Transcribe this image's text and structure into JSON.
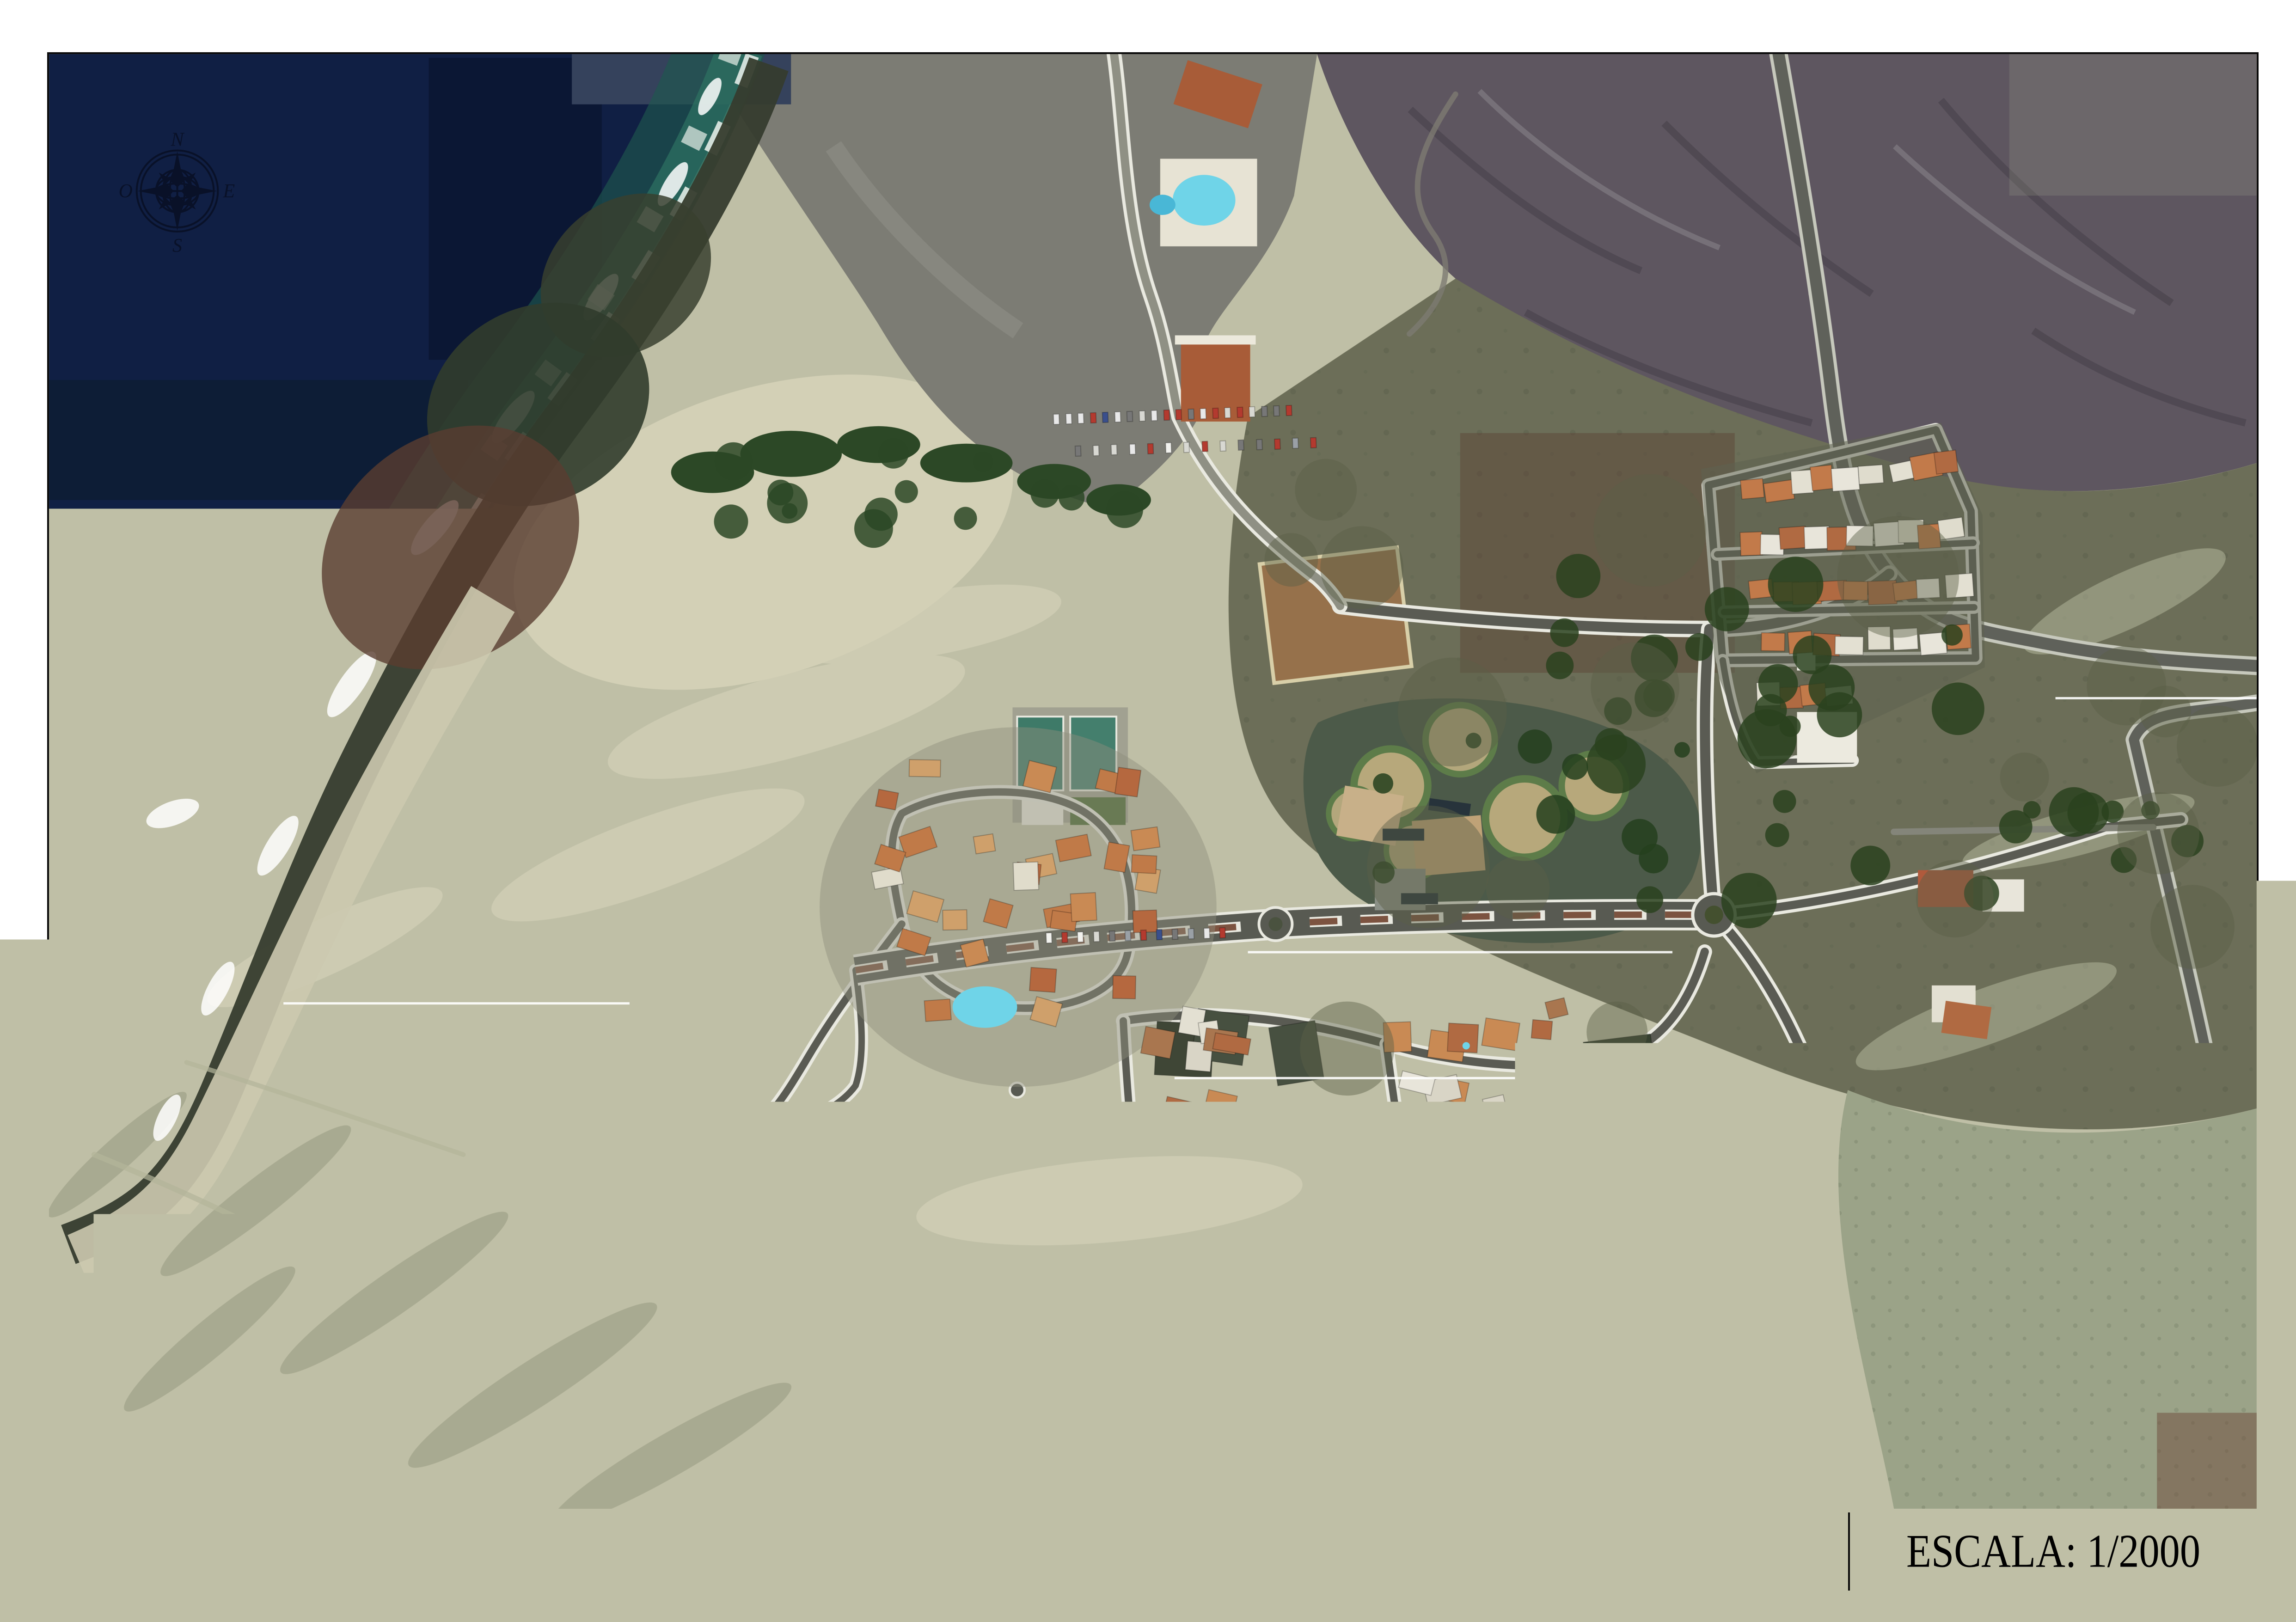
{
  "title_block": {
    "title": "URBANIZACIÓN LA PARED - PÁJARA - FUERTEVENTURA",
    "format_label": "FORMATO PAPEL:",
    "format_value": "ISO A-1",
    "scale_text": "ESCALA: 1/2000"
  },
  "compass": {
    "north_label": "N",
    "east_label": "E",
    "south_label": "S",
    "west_label": "O"
  },
  "map": {
    "feature_names": [
      "ocean",
      "surf-and-foam",
      "rocky-shore",
      "beach-cove",
      "sand-dunes",
      "mountain-slopes",
      "scrubland",
      "hotel-resort",
      "housing-clusters",
      "street-network",
      "swimming-pools",
      "sports-pitch",
      "park-circles",
      "compass-rose"
    ],
    "colors": {
      "ocean": "#101f44",
      "surf": "#2e7263",
      "foam": "#ffffff",
      "sand": "#bfbfa6",
      "pale_sand": "#d3d0b6",
      "scrub_olive": "#6c6e58",
      "mountain_gray": "#5e5660",
      "slope_gray": "#7c7c74",
      "road_gray": "#5a5b53",
      "curb_white": "#e9e9e0",
      "roof_terracotta": "#b06a42",
      "roof_white": "#e8e5da",
      "pool_cyan": "#6fd4e8",
      "vegetation": "#2c4826"
    }
  }
}
